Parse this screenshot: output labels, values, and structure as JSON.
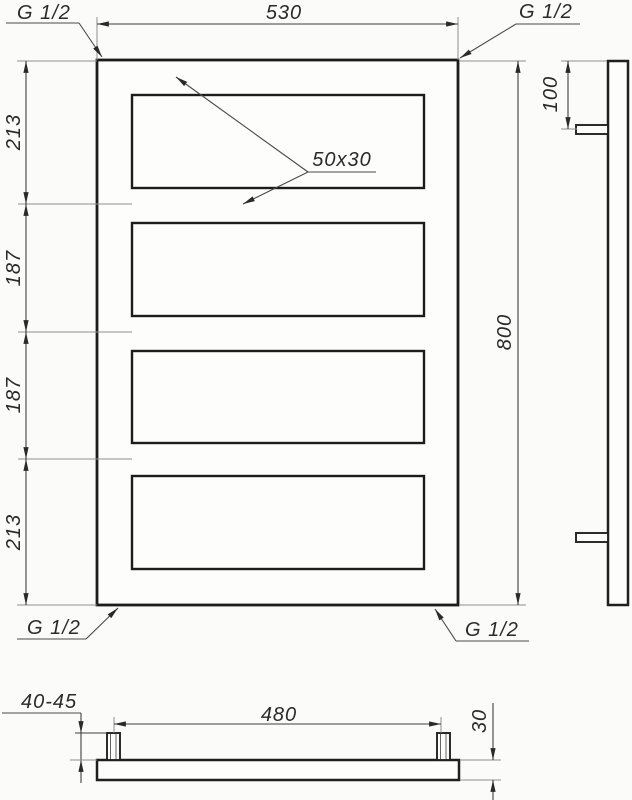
{
  "labels": {
    "thread_top_left": "G 1/2",
    "thread_top_right": "G 1/2",
    "thread_bottom_left": "G 1/2",
    "thread_bottom_right": "G 1/2",
    "overall_width": "530",
    "overall_height": "800",
    "chain_top": "213",
    "chain_upper_middle": "187",
    "chain_lower_middle": "187",
    "chain_bottom": "213",
    "tube_profile": "50x30",
    "side_port_offset": "100",
    "port_spacing": "480",
    "port_stub_height": "40-45",
    "profile_thickness": "30"
  },
  "colors": {
    "background": "#fbfbfa",
    "main_line": "#1c1c1c",
    "dimension_line": "#3f3f3f",
    "extension_line": "#8f8f8f",
    "text": "#2a2a2a"
  }
}
